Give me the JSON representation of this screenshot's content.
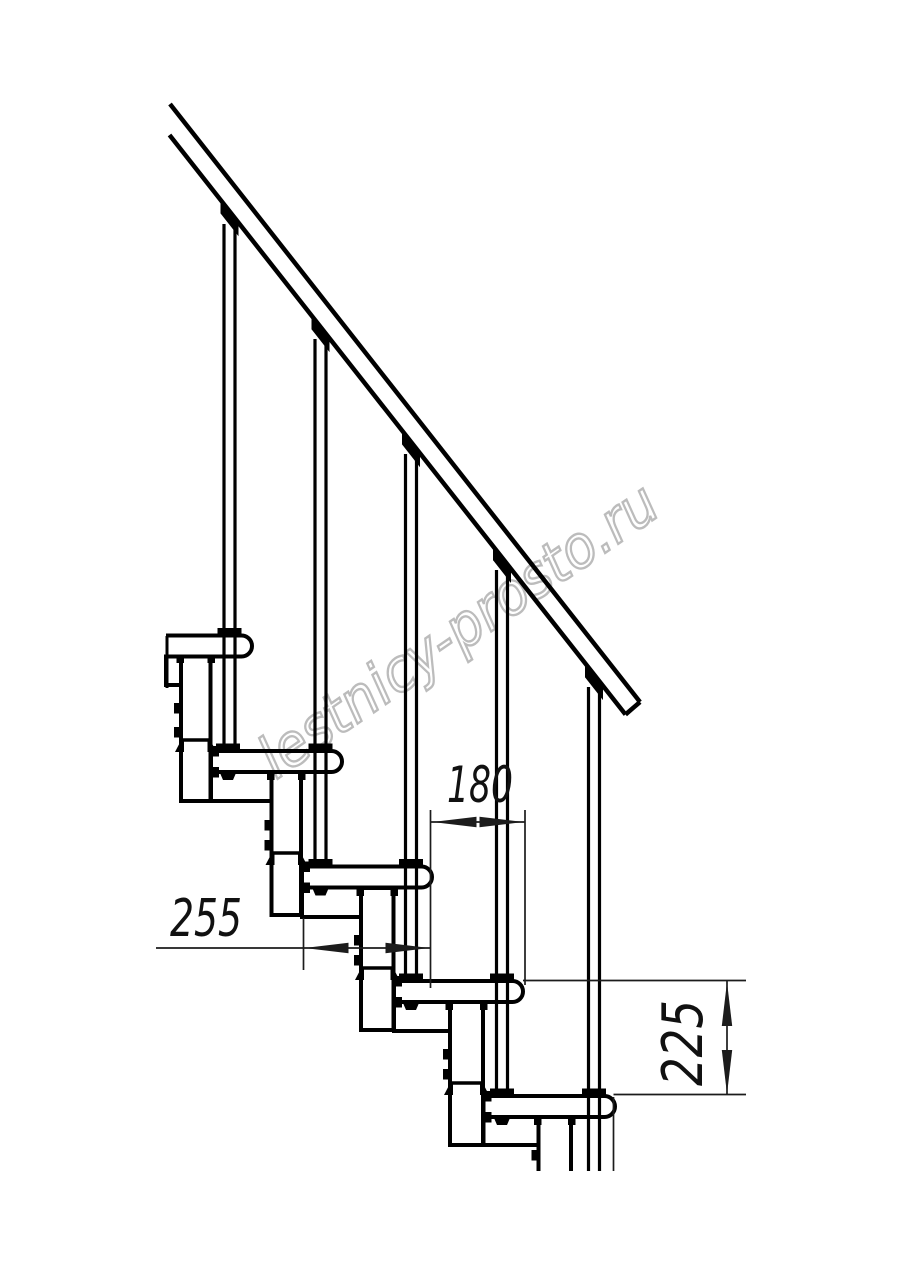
{
  "page": {
    "width": 914,
    "height": 1280,
    "background": "#ffffff"
  },
  "colors": {
    "line": "#000000",
    "dim_line": "#1c1c1c",
    "dim_text": "#111111",
    "watermark": "#b5b5b5"
  },
  "watermark": {
    "text": "lestnicy-prosto.ru",
    "x": 276,
    "y": 780,
    "rotate": -34.6,
    "size": 58,
    "length": 470
  },
  "dimensions": [
    {
      "label": "180",
      "unit_hint": "mm",
      "text": {
        "x": 447,
        "y": 802,
        "size": 50,
        "len": 66,
        "rotate": 0
      },
      "line": {
        "x1": 431,
        "y1": 822,
        "x2": 525,
        "y2": 822
      },
      "arrows": [
        {
          "x": 432.5,
          "y": 822,
          "dir": "left"
        },
        {
          "x": 523.5,
          "y": 822,
          "dir": "right"
        }
      ],
      "exts": [
        {
          "x1": 430.5,
          "y1": 810,
          "x2": 430.5,
          "y2": 988
        },
        {
          "x1": 525,
          "y1": 810,
          "x2": 525,
          "y2": 985
        }
      ]
    },
    {
      "label": "255",
      "unit_hint": "mm",
      "text": {
        "x": 170,
        "y": 936,
        "size": 52,
        "len": 72,
        "rotate": 0
      },
      "line": {
        "x1": 156,
        "y1": 948,
        "x2": 430.5,
        "y2": 948
      },
      "arrows": [
        {
          "x": 304.5,
          "y": 948,
          "dir": "left"
        },
        {
          "x": 429.5,
          "y": 948,
          "dir": "right"
        }
      ],
      "exts": [
        {
          "x1": 303.5,
          "y1": 918,
          "x2": 303.5,
          "y2": 970
        }
      ]
    },
    {
      "label": "225",
      "unit_hint": "mm",
      "text": {
        "x": 702,
        "y": 1086,
        "size": 56,
        "len": 86,
        "rotate": -90
      },
      "line": {
        "x1": 727,
        "y1": 981,
        "x2": 727,
        "y2": 1095
      },
      "arrows": [
        {
          "x": 727,
          "y": 982,
          "dir": "up"
        },
        {
          "x": 727,
          "y": 1094,
          "dir": "down"
        }
      ],
      "exts": [
        {
          "x1": 523,
          "y1": 980.5,
          "x2": 746,
          "y2": 980.5
        },
        {
          "x1": 613.5,
          "y1": 1094.5,
          "x2": 746,
          "y2": 1094.5
        },
        {
          "x1": 613.5,
          "y1": 1097,
          "x2": 613.5,
          "y2": 1171
        }
      ]
    }
  ],
  "drawing": {
    "stroke_w": {
      "structure": 4,
      "rail": 4.5,
      "tube": 3.2,
      "thin": 3.4,
      "dim": 1.7
    },
    "handrail": {
      "points": [
        [
          170,
          104
        ],
        [
          640,
          702
        ],
        [
          625.5,
          714.5
        ],
        [
          169.5,
          135
        ]
      ],
      "open_left": true
    },
    "rail_line": {
      "x0": 169.5,
      "y0": 135,
      "slope": 1.2725
    },
    "cut_edge": {
      "x": 167,
      "y1": 636,
      "y2": 688
    },
    "treads": [
      {
        "left": 166,
        "right": 252,
        "top": 635.5,
        "h": 21,
        "r": 10.5,
        "cut_left": true,
        "ring_cx": 229.5,
        "foot_cx": null,
        "edge_bolts": false
      },
      {
        "left": 211,
        "right": 342,
        "top": 751,
        "h": 21,
        "r": 10.5,
        "cut_left": false,
        "ring_cx": 320.5,
        "foot_cx": 228,
        "edge_bolts": true
      },
      {
        "left": 302,
        "right": 432,
        "top": 866.5,
        "h": 21,
        "r": 10.5,
        "cut_left": false,
        "ring_cx": 411,
        "foot_cx": 320.5,
        "edge_bolts": true
      },
      {
        "left": 394,
        "right": 523,
        "top": 981,
        "h": 21,
        "r": 10.5,
        "cut_left": false,
        "ring_cx": 502,
        "foot_cx": 411,
        "edge_bolts": true
      },
      {
        "left": 483.5,
        "right": 615,
        "top": 1096,
        "h": 21,
        "r": 10.5,
        "cut_left": false,
        "ring_cx": 594,
        "foot_cx": 502,
        "edge_bolts": true
      }
    ],
    "underplates": [
      {
        "x": 166,
        "x2": 181,
        "top": 656.5,
        "bottom": 685
      },
      {
        "x": 211,
        "x2": 271.5,
        "top": 772,
        "bottom": 801
      },
      {
        "x": 302,
        "x2": 361,
        "top": 887.5,
        "bottom": 917
      },
      {
        "x": 394,
        "x2": 450,
        "top": 1002,
        "bottom": 1031
      },
      {
        "x": 483.5,
        "x2": 538.5,
        "top": 1117,
        "bottom": 1145
      }
    ],
    "columns": [
      {
        "x": 181,
        "w": 29.5,
        "top": 655,
        "bottom": 801,
        "collar": 740,
        "bolts": [
          703,
          727
        ],
        "cut": false
      },
      {
        "x": 271.5,
        "w": 29.5,
        "top": 772,
        "bottom": 915,
        "collar": 853,
        "bolts": [
          820,
          840
        ],
        "cut": false
      },
      {
        "x": 361,
        "w": 32.5,
        "top": 888,
        "bottom": 1030,
        "collar": 968,
        "bolts": [
          935,
          955
        ],
        "cut": false
      },
      {
        "x": 450,
        "w": 33,
        "top": 1002,
        "bottom": 1145,
        "collar": 1083,
        "bolts": [
          1049,
          1069
        ],
        "cut": false
      },
      {
        "x": 538.5,
        "w": 32.5,
        "top": 1117,
        "bottom": 1171,
        "collar": null,
        "bolts": [
          1150
        ],
        "cut": true
      }
    ],
    "balusters": [
      {
        "cx": 229.5,
        "top": 224,
        "bottom": 748,
        "cut": false
      },
      {
        "cx": 320.5,
        "top": 339,
        "bottom": 863,
        "cut": false
      },
      {
        "cx": 411,
        "top": 454,
        "bottom": 978,
        "cut": false
      },
      {
        "cx": 502,
        "top": 570,
        "bottom": 1093,
        "cut": false
      },
      {
        "cx": 594,
        "top": 687,
        "bottom": 1171,
        "cut": true
      }
    ]
  }
}
